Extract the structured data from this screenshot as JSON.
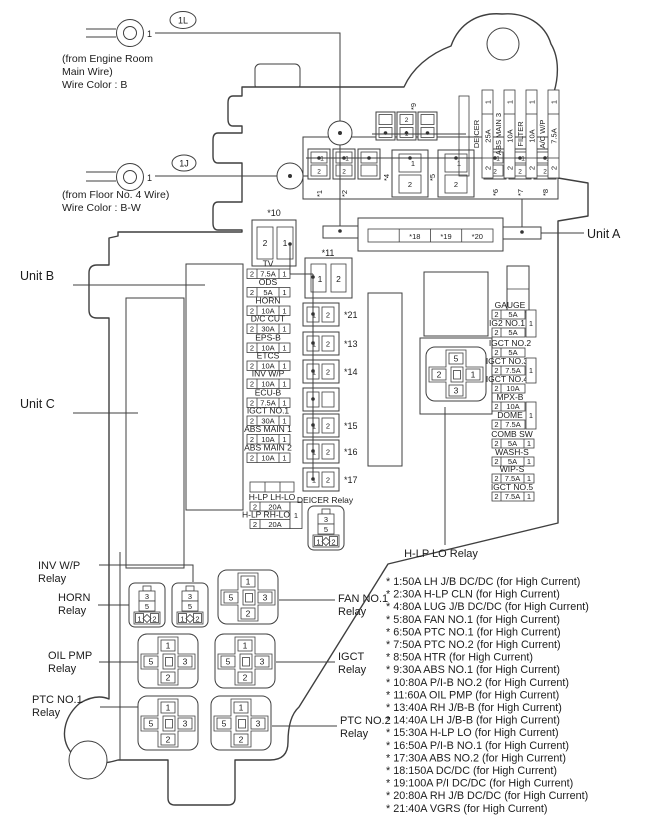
{
  "t": {
    "one": "1",
    "two": "2",
    "three": "3",
    "five": "5"
  },
  "annotations": {
    "wire1": {
      "tag": "1L",
      "pin": "1",
      "line1": "(from Engine Room",
      "line2": "Main Wire)",
      "line3": "Wire Color : B"
    },
    "wire2": {
      "tag": "1J",
      "pin": "1",
      "line1": "(from Floor No. 4 Wire)",
      "line2": "Wire Color : B-W"
    }
  },
  "units": {
    "a": "Unit A",
    "b": "Unit B",
    "c": "Unit C"
  },
  "connectors": {
    "c9": "*9",
    "c10": "*10",
    "c11": "*11"
  },
  "top_row": {
    "labels": [
      "*1",
      "*2",
      "*4",
      "*5",
      "*6",
      "*7",
      "*8"
    ]
  },
  "unit_a": {
    "cells": [
      "*18",
      "*19",
      "*20"
    ]
  },
  "vertical_fuses": [
    {
      "name": "DEICER",
      "amp": "25A"
    },
    {
      "name": "ABS MAIN 3",
      "amp": "10A"
    },
    {
      "name": "FILTER",
      "amp": "10A"
    },
    {
      "name": "A/C W/P",
      "amp": "7.5A"
    }
  ],
  "left_fuses": [
    {
      "name": "TV",
      "amp": "7.5A"
    },
    {
      "name": "ODS",
      "amp": "5A"
    },
    {
      "name": "HORN",
      "amp": "10A"
    },
    {
      "name": "D/C CUT",
      "amp": "30A"
    },
    {
      "name": "EPS-B",
      "amp": "10A"
    },
    {
      "name": "ETCS",
      "amp": "10A"
    },
    {
      "name": "INV W/P",
      "amp": "10A"
    },
    {
      "name": "ECU-B",
      "amp": "7.5A"
    },
    {
      "name": "IGCT NO.1",
      "amp": "30A"
    },
    {
      "name": "ABS MAIN 1",
      "amp": "10A"
    },
    {
      "name": "ABS MAIN 2",
      "amp": "10A"
    }
  ],
  "hlp": {
    "lh_name": "H-LP LH-LO",
    "lh_amp": "20A",
    "rh_name": "H-LP RH-LO",
    "rh_amp": "20A"
  },
  "mid_connectors": {
    "labels": [
      "*21",
      "*13",
      "*14",
      "*15",
      "*16",
      "*17"
    ]
  },
  "right_fuses": [
    {
      "name": "GAUGE",
      "amp": "5A"
    },
    {
      "name": "IG2 NO.1",
      "amp": "5A"
    },
    {
      "name": "IGCT NO.2",
      "amp": "5A"
    },
    {
      "name": "IGCT NO.3",
      "amp": "7.5A"
    },
    {
      "name": "IGCT NO.4",
      "amp": "10A"
    },
    {
      "name": "MPX-B",
      "amp": "10A"
    },
    {
      "name": "DOME",
      "amp": "7.5A"
    },
    {
      "name": "COMB SW",
      "amp": "5A"
    },
    {
      "name": "WASH-S",
      "amp": "5A"
    },
    {
      "name": "WIP-S",
      "amp": "7.5A"
    },
    {
      "name": "IGCT NO.5",
      "amp": "7.5A"
    }
  ],
  "relays": {
    "inv_wp": {
      "l1": "INV W/P",
      "l2": "Relay"
    },
    "horn": {
      "l1": "HORN",
      "l2": "Relay"
    },
    "oil_pmp": {
      "l1": "OIL PMP",
      "l2": "Relay"
    },
    "ptc1": {
      "l1": "PTC NO.1",
      "l2": "Relay"
    },
    "fan1": {
      "l1": "FAN NO.1",
      "l2": "Relay"
    },
    "igct": {
      "l1": "IGCT",
      "l2": "Relay"
    },
    "ptc2": {
      "l1": "PTC NO.2",
      "l2": "Relay"
    },
    "hlp_lo": "H-LP LO Relay",
    "deicer": "DEICER Relay"
  },
  "legend": {
    "lines": [
      "* 1:50A LH J/B DC/DC (for High Current)",
      "* 2:30A H-LP CLN (for High Current)",
      "* 4:80A LUG J/B DC/DC (for High Current)",
      "* 5:80A FAN NO.1 (for High Current)",
      "* 6:50A PTC NO.1 (for High Current)",
      "* 7:50A PTC NO.2 (for High Current)",
      "* 8:50A HTR (for High Current)",
      "* 9:30A ABS NO.1 (for High Current)",
      "* 10:80A P/I-B NO.2 (for High Current)",
      "* 11:60A OIL PMP (for High Current)",
      "* 13:40A RH J/B-B (for High Current)",
      "* 14:40A LH J/B-B (for High Current)",
      "* 15:30A H-LP LO (for High Current)",
      "* 16:50A P/I-B NO.1 (for High Current)",
      "* 17:30A ABS NO.2 (for High Current)",
      "* 18:150A DC/DC (for High Current)",
      "* 19:100A P/I DC/DC (for High Current)",
      "* 20:80A RH J/B DC/DC (for High Current)",
      "* 21:40A VGRS (for High Current)"
    ]
  }
}
